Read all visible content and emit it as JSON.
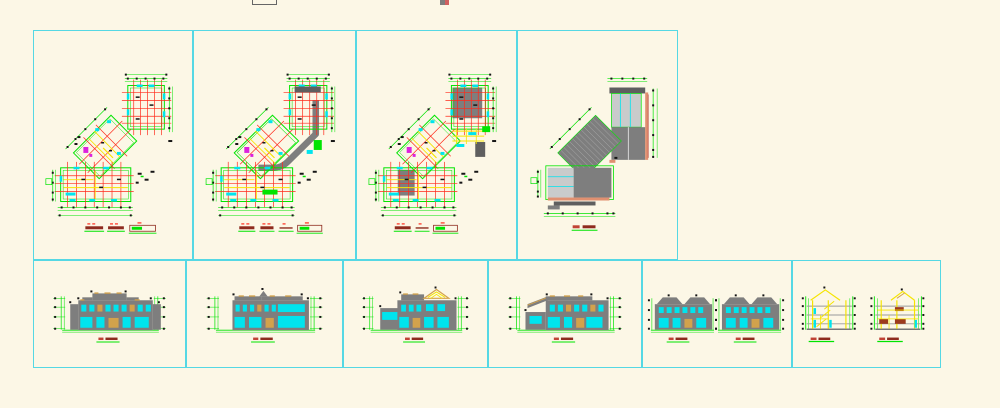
{
  "canvas": {
    "width": 1000,
    "height": 408,
    "background": "#FCF7E6",
    "frame_border_color": "#55D8E4"
  },
  "palette": {
    "green": "#00E400",
    "red": "#FF2A1A",
    "yellow": "#F5E400",
    "cyan": "#00E4EE",
    "magenta": "#DD22DD",
    "gray": "#7E7E7E",
    "dark_gray": "#5F5F5F",
    "light_gray": "#C9CBCB",
    "dark_red": "#8E2B1E",
    "bright_red": "#C04335",
    "salmon": "#E09070",
    "orange": "#D2A24C",
    "brown": "#9C3A1E",
    "black": "#141414",
    "white": "#EEEEEE"
  },
  "frames": [
    {
      "id": "floor-plan-1",
      "row": "top",
      "kind": "floor-plan",
      "variant": "base",
      "legend": [
        {
          "type": "bar"
        },
        {
          "type": "bar"
        },
        {
          "type": "outline"
        }
      ]
    },
    {
      "id": "floor-plan-2",
      "row": "top",
      "kind": "floor-plan",
      "variant": "gray-band",
      "legend": [
        {
          "type": "bar"
        },
        {
          "type": "bar"
        },
        {
          "type": "line"
        },
        {
          "type": "outline"
        }
      ]
    },
    {
      "id": "floor-plan-3",
      "row": "top",
      "kind": "floor-plan",
      "variant": "partial-roof",
      "legend": [
        {
          "type": "bar"
        },
        {
          "type": "line"
        },
        {
          "type": "outline"
        }
      ]
    },
    {
      "id": "roof-plan",
      "row": "top",
      "kind": "roof-plan",
      "variant": "roof",
      "legend": [
        {
          "type": "bar"
        },
        {
          "type": "bar"
        }
      ]
    },
    {
      "id": "elevation-1",
      "row": "bottom",
      "kind": "elevation",
      "variant": "e1",
      "legend": [
        {
          "type": "bar"
        },
        {
          "type": "bar"
        }
      ]
    },
    {
      "id": "elevation-2",
      "row": "bottom",
      "kind": "elevation",
      "variant": "e2",
      "legend": [
        {
          "type": "bar"
        },
        {
          "type": "bar"
        }
      ]
    },
    {
      "id": "elevation-3",
      "row": "bottom",
      "kind": "elevation",
      "variant": "e3",
      "legend": [
        {
          "type": "bar"
        },
        {
          "type": "bar"
        }
      ]
    },
    {
      "id": "elevation-4",
      "row": "bottom",
      "kind": "elevation",
      "variant": "e4",
      "legend": [
        {
          "type": "bar"
        },
        {
          "type": "bar"
        }
      ]
    },
    {
      "id": "elevation-pair",
      "row": "bottom",
      "kind": "elevation-pair",
      "variant": "e5",
      "legend": [
        {
          "type": "bar"
        },
        {
          "type": "bar"
        }
      ]
    },
    {
      "id": "section-pair",
      "row": "bottom",
      "kind": "section-pair",
      "variant": "e6",
      "legend": [
        {
          "type": "bar"
        },
        {
          "type": "bar"
        }
      ]
    }
  ],
  "stray_objects": [
    {
      "id": "partial-box",
      "x": 252,
      "y": 0,
      "width": 23,
      "height": 4
    },
    {
      "id": "partial-gray-red-mark",
      "x": 440,
      "y": 0,
      "width": 9,
      "height": 5
    }
  ]
}
